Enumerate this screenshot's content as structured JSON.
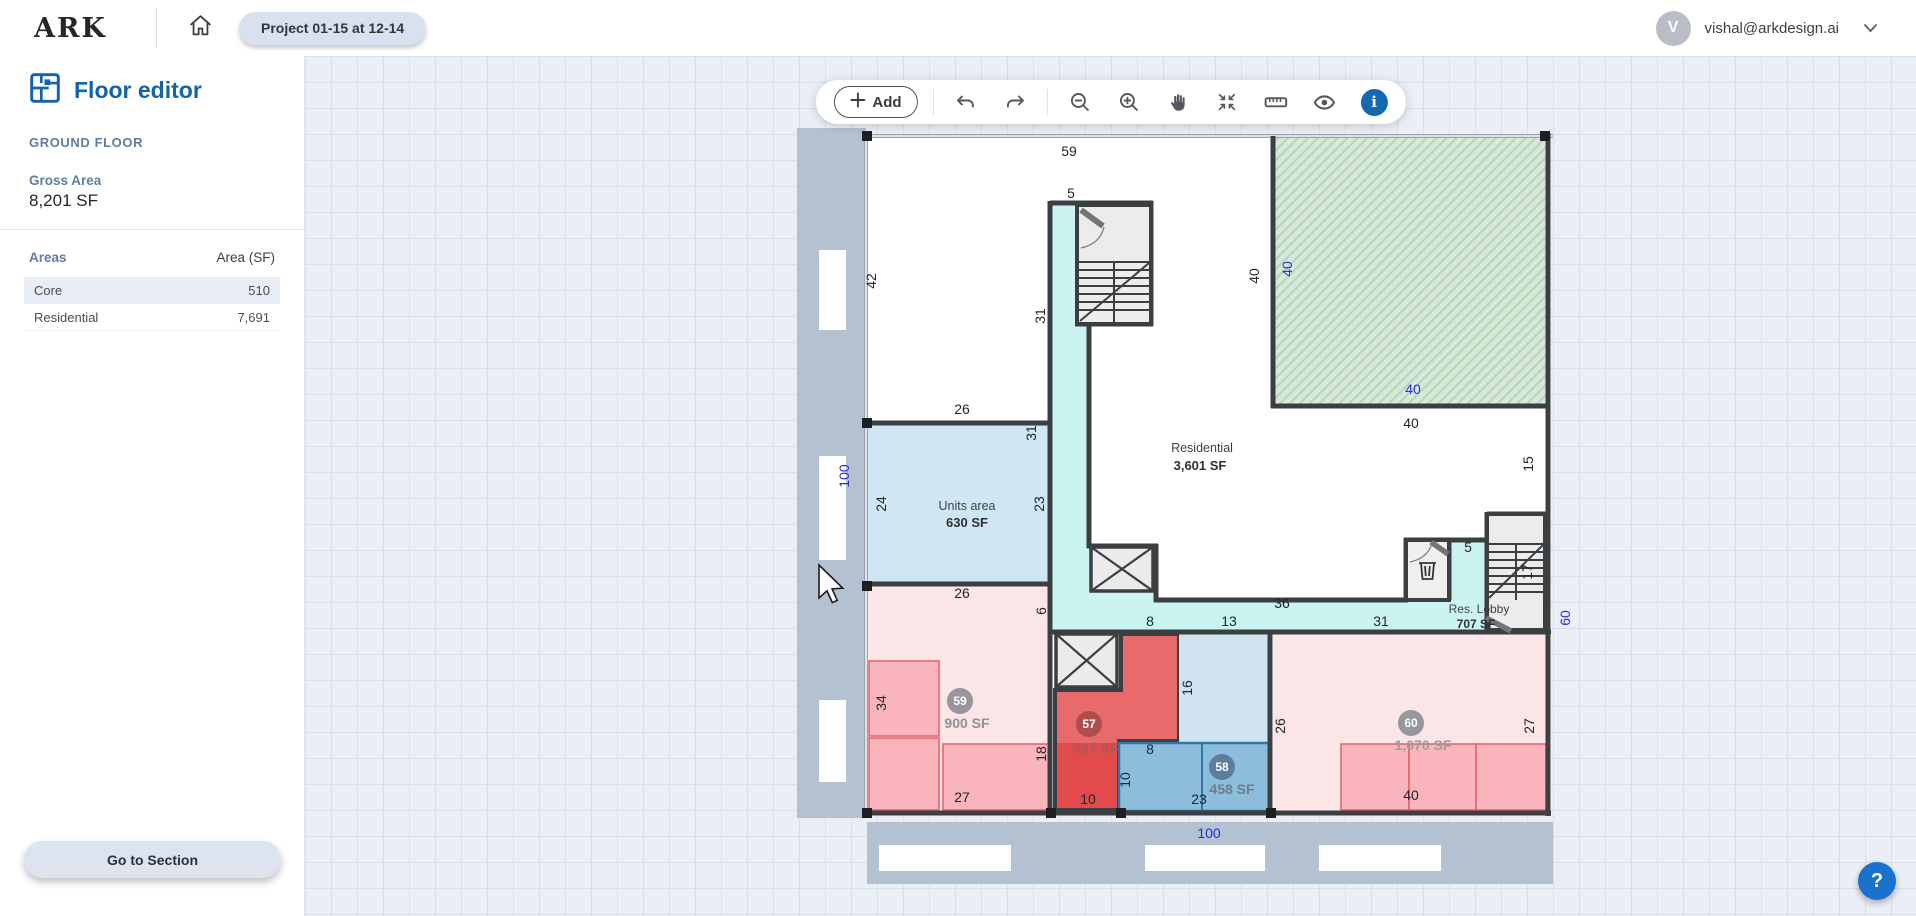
{
  "topbar": {
    "logo": "ARK",
    "project_tab": "Project 01-15 at 12-14",
    "user_email": "vishal@arkdesign.ai",
    "avatar_initial": "V"
  },
  "sidebar": {
    "title": "Floor editor",
    "floor_name": "GROUND FLOOR",
    "gross_area_label": "Gross Area",
    "gross_area_value": "8,201 SF",
    "areas_title": "Areas",
    "areas_column": "Area (SF)",
    "areas_rows": [
      {
        "name": "Core",
        "value": "510"
      },
      {
        "name": "Residential",
        "value": "7,691"
      }
    ],
    "go_to_section_label": "Go to Section"
  },
  "toolbar": {
    "add_label": "Add",
    "info_glyph": "i",
    "icons": [
      "undo",
      "redo",
      "zoom-out",
      "zoom-in",
      "pan-hand",
      "fit-view",
      "ruler",
      "visibility",
      "info"
    ]
  },
  "help_button": {
    "glyph": "?"
  },
  "plan": {
    "dims": [
      {
        "t": "59"
      },
      {
        "t": "5"
      },
      {
        "t": "42"
      },
      {
        "t": "31"
      },
      {
        "t": "40"
      },
      {
        "t": "26"
      },
      {
        "t": "40"
      },
      {
        "t": "15"
      },
      {
        "t": "31"
      },
      {
        "t": "24"
      },
      {
        "t": "23"
      },
      {
        "t": "5"
      },
      {
        "t": "17"
      },
      {
        "t": "26"
      },
      {
        "t": "36"
      },
      {
        "t": "8"
      },
      {
        "t": "13"
      },
      {
        "t": "31"
      },
      {
        "t": "6"
      },
      {
        "t": "34"
      },
      {
        "t": "16"
      },
      {
        "t": "26"
      },
      {
        "t": "27"
      },
      {
        "t": "18"
      },
      {
        "t": "8"
      },
      {
        "t": "10"
      },
      {
        "t": "27"
      },
      {
        "t": "10"
      },
      {
        "t": "23"
      },
      {
        "t": "40"
      }
    ],
    "blue_dims": [
      {
        "t": "100"
      },
      {
        "t": "40"
      },
      {
        "t": "40"
      },
      {
        "t": "60"
      },
      {
        "t": "100"
      }
    ],
    "labels": {
      "units_area_name": "Units area",
      "units_area_value": "630 SF",
      "residential_name": "Residential",
      "residential_value": "3,601 SF",
      "lobby_name": "Res. Lobby",
      "lobby_value": "707 SF"
    },
    "units": [
      {
        "badge": "59",
        "area": "900 SF"
      },
      {
        "badge": "57",
        "area": "327 SF"
      },
      {
        "badge": "58",
        "area": "458 SF"
      },
      {
        "badge": "60",
        "area": "1,070 SF"
      }
    ],
    "colors": {
      "wall": "#3b3f42",
      "corridor_cyan": "#cbf3f2",
      "units_area_blue": "#cfe6f4",
      "residential_pink": "#fce5e7",
      "unit_pink": "#f9b5bb",
      "red_room": "#e96a6a",
      "red_room_dark": "#e14b4b",
      "blue_room": "#8cbdda",
      "blue_room_light": "#cfe3f0",
      "green_area": "#d8e9da",
      "sidewalk_gray": "#b4c1d1",
      "dim_text": "#212428",
      "dim_blue": "#2929d6",
      "accent_blue": "#1463a8"
    }
  }
}
